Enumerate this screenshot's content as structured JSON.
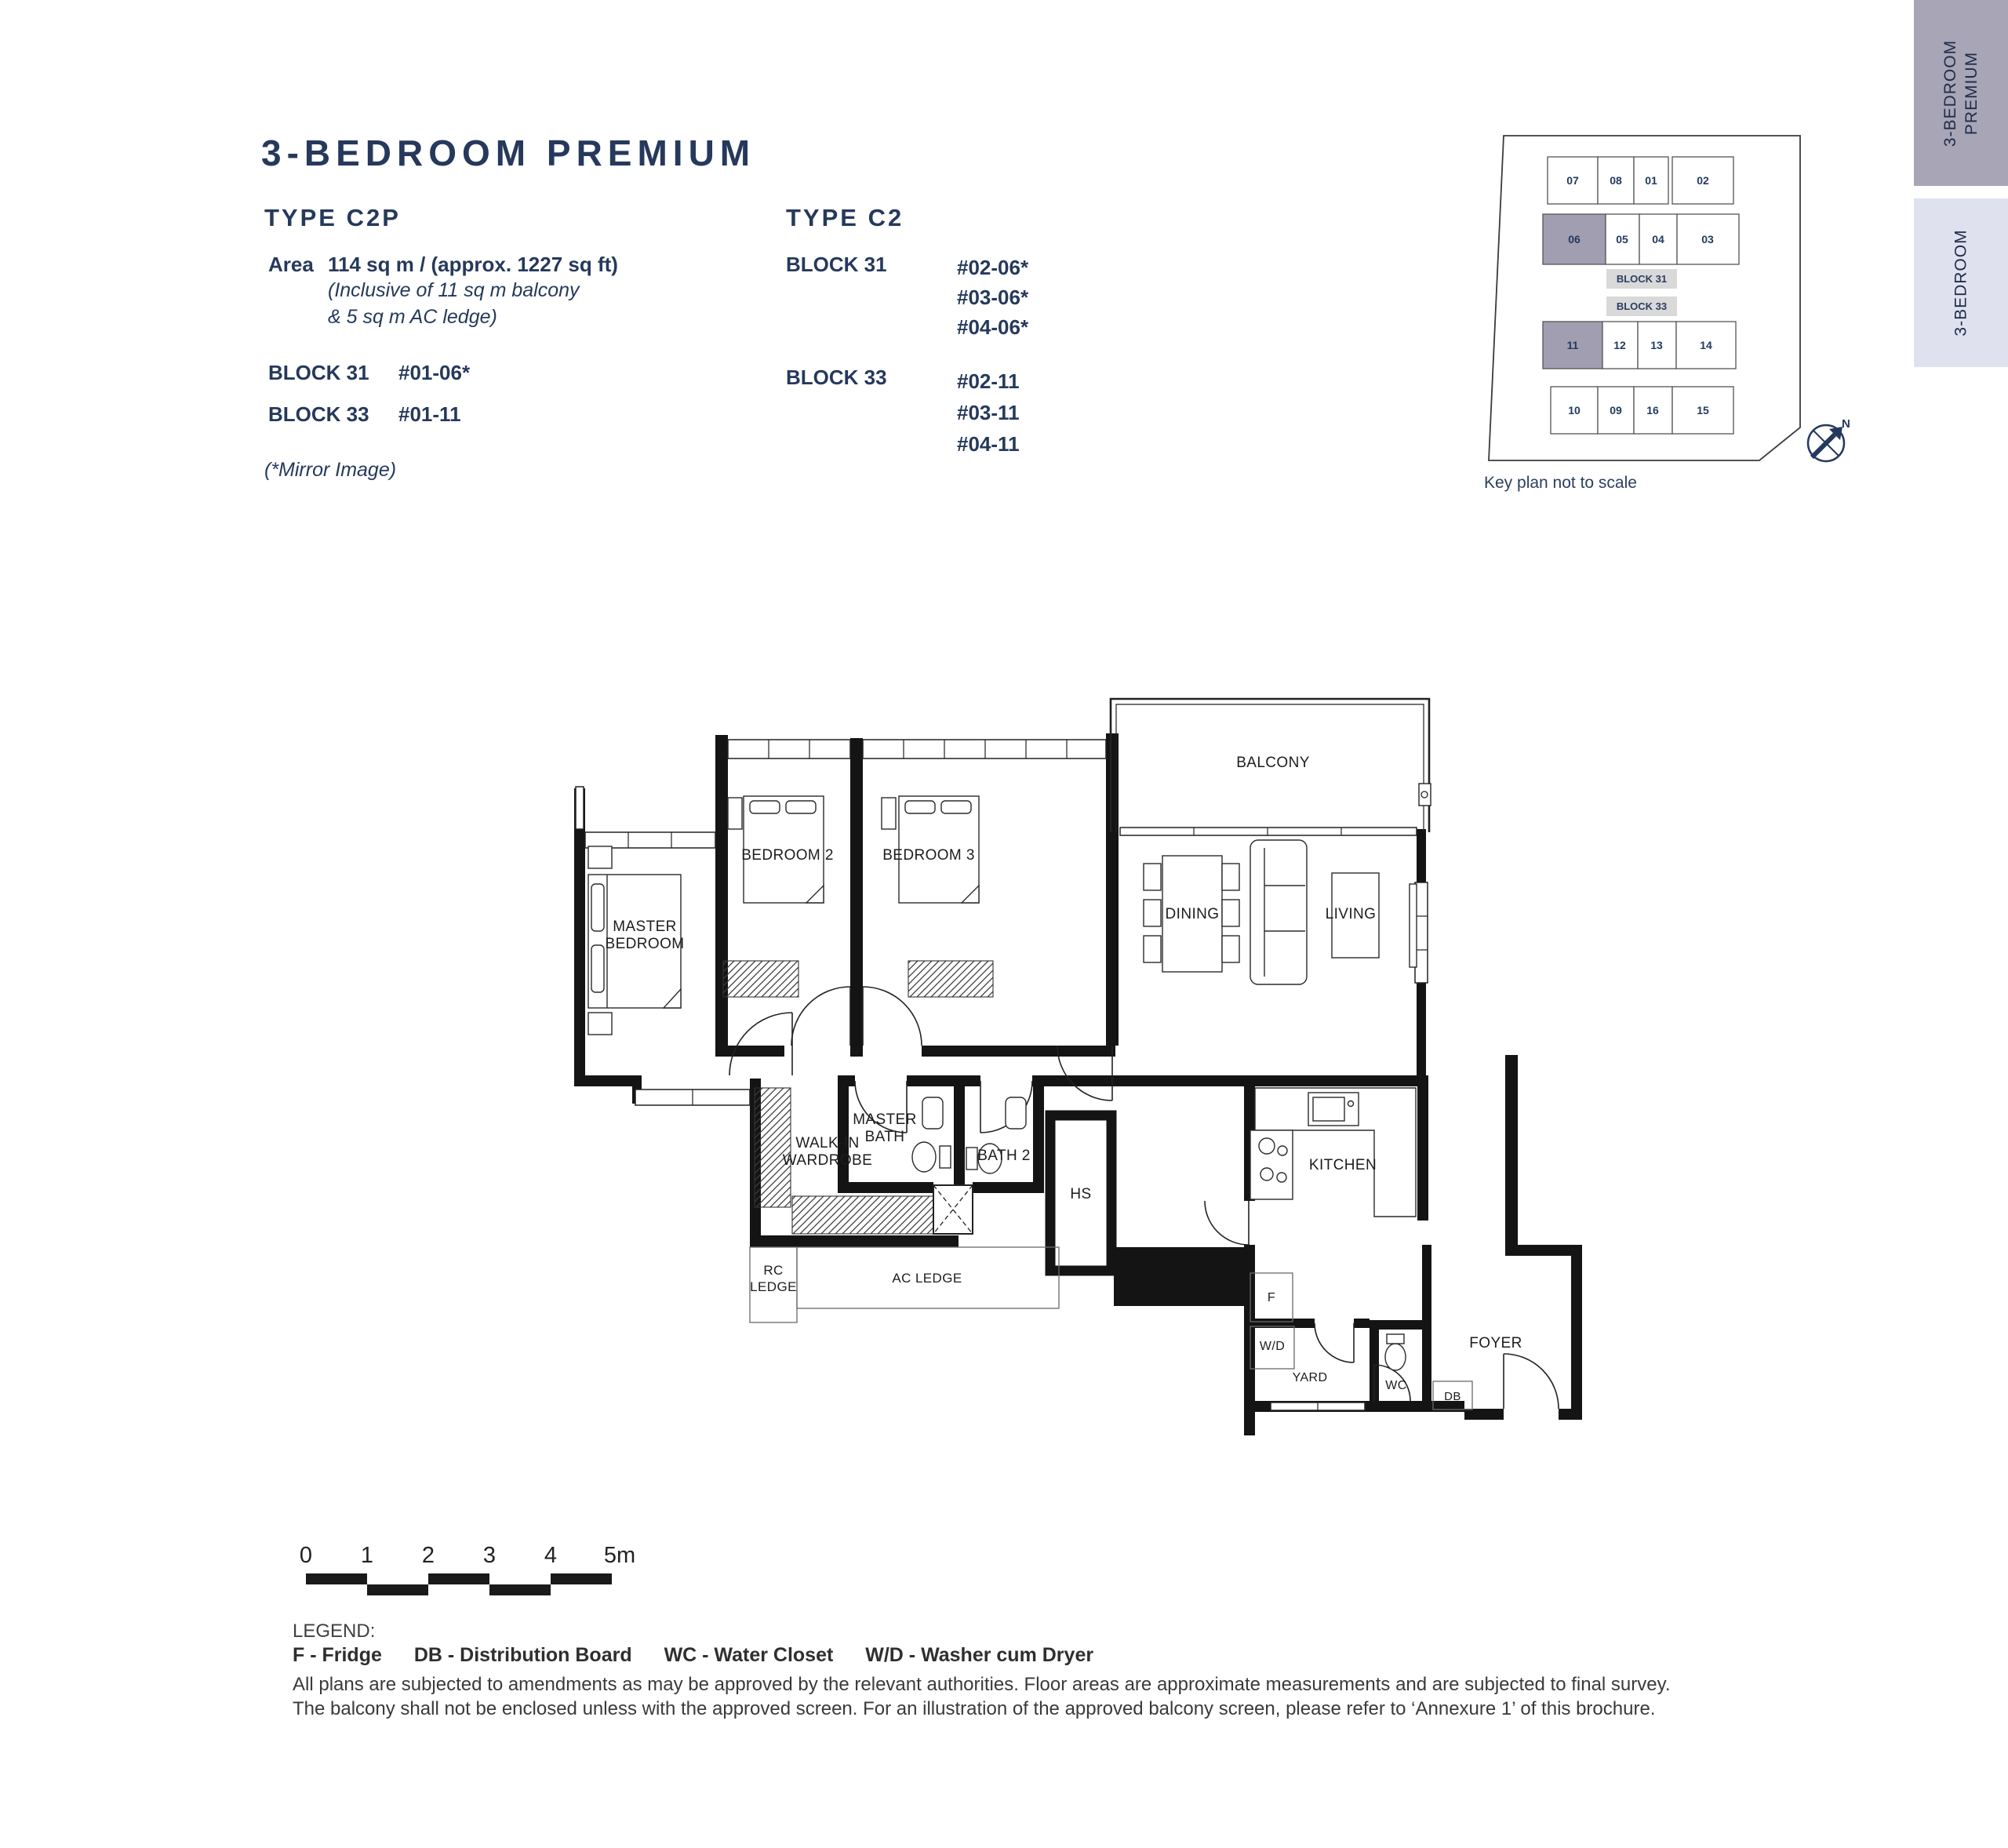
{
  "header": {
    "title": "3-BEDROOM PREMIUM"
  },
  "colors": {
    "accent_navy": "#26395c",
    "tab_active_bg": "#a7a5b6",
    "tab_inactive_bg": "#dfe2ee",
    "keyplan_highlight_fill": "#a19eb2",
    "keyplan_tag_bg": "#d9d9d9"
  },
  "type_c2p": {
    "heading": "TYPE C2P",
    "area_label": "Area",
    "area_value": "114 sq m / (approx. 1227 sq ft)",
    "area_note_line1": "(Inclusive of 11 sq m balcony",
    "area_note_line2": "& 5 sq m AC ledge)",
    "block31_label": "BLOCK 31",
    "block31_unit": "#01-06*",
    "block33_label": "BLOCK 33",
    "block33_unit": "#01-11",
    "mirror_note": "(*Mirror Image)"
  },
  "type_c2": {
    "heading": "TYPE C2",
    "block31_label": "BLOCK 31",
    "block31_units": [
      "#02-06*",
      "#03-06*",
      "#04-06*"
    ],
    "block33_label": "BLOCK 33",
    "block33_units": [
      "#02-11",
      "#03-11",
      "#04-11"
    ]
  },
  "side_tabs": [
    {
      "line1": "3-BEDROOM",
      "line2": "PREMIUM",
      "active": true
    },
    {
      "line1": "3-BEDROOM",
      "line2": "",
      "active": false
    }
  ],
  "key_plan": {
    "caption": "Key plan not to scale",
    "block31_tag": "BLOCK 31",
    "block33_tag": "BLOCK 33",
    "north_label": "N",
    "rows": [
      [
        "07",
        "08",
        "01",
        "02"
      ],
      [
        "06",
        "05",
        "04",
        "03"
      ],
      [
        "11",
        "12",
        "13",
        "14"
      ],
      [
        "10",
        "09",
        "16",
        "15"
      ]
    ],
    "highlighted_units": [
      "06",
      "11"
    ]
  },
  "floor_plan": {
    "rooms": {
      "master_bedroom": [
        "MASTER",
        "BEDROOM"
      ],
      "bedroom2": [
        "BEDROOM 2"
      ],
      "bedroom3": [
        "BEDROOM 3"
      ],
      "balcony": [
        "BALCONY"
      ],
      "dining": [
        "DINING"
      ],
      "living": [
        "LIVING"
      ],
      "walk_in_wardrobe": [
        "WALK-IN",
        "WARDROBE"
      ],
      "master_bath": [
        "MASTER",
        "BATH"
      ],
      "bath2": [
        "BATH 2"
      ],
      "hs": [
        "HS"
      ],
      "kitchen": [
        "KITCHEN"
      ],
      "rc_ledge": [
        "RC",
        "LEDGE"
      ],
      "ac_ledge": [
        "AC LEDGE"
      ],
      "fridge": [
        "F"
      ],
      "washer_dryer": [
        "W/D"
      ],
      "yard": [
        "YARD"
      ],
      "wc": [
        "WC"
      ],
      "db": [
        "DB"
      ],
      "foyer": [
        "FOYER"
      ]
    }
  },
  "scale_bar": {
    "ticks": [
      "0",
      "1",
      "2",
      "3",
      "4",
      "5m"
    ]
  },
  "legend": {
    "heading": "LEGEND:",
    "items": [
      "F - Fridge",
      "DB - Distribution Board",
      "WC - Water Closet",
      "W/D - Washer cum Dryer"
    ]
  },
  "disclaimer": [
    "All plans are subjected to amendments as may be approved by the relevant authorities. Floor areas are approximate measurements and are subjected to final survey.",
    "The balcony shall not be enclosed unless with the approved screen. For an illustration of the approved balcony screen, please refer to ‘Annexure 1’ of this brochure."
  ]
}
